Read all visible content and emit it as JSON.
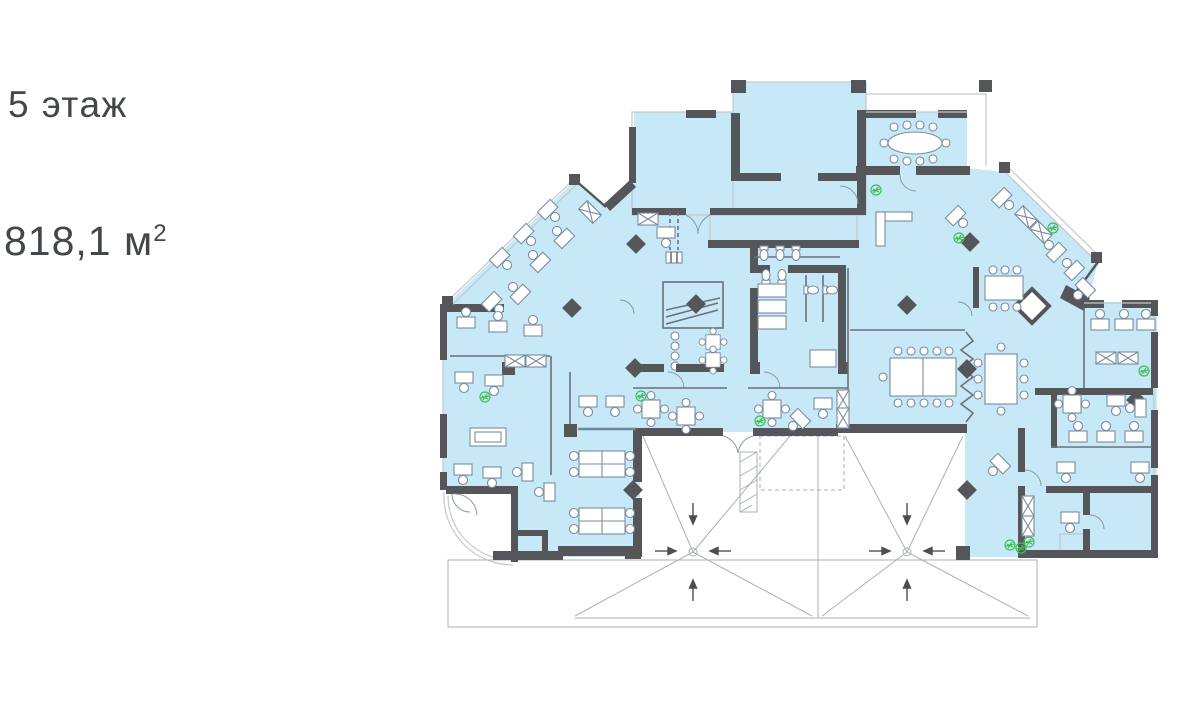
{
  "labels": {
    "floor": "5 этаж",
    "area_value": "818,1",
    "area_unit": "м",
    "area_sup": "2",
    "text_color": "#43474b"
  },
  "plan": {
    "description_icons": {
      "plant-icon": "green potted plant marker",
      "roof-drain-arrow-icon": "roof slope arrow",
      "column-icon": "dark diamond structural column",
      "elevator-icon": "dark diamond in stair core",
      "workstation-icon": "desk with chair",
      "storage-icon": "crossed box shelving",
      "toilet-icon": "wc fixture"
    },
    "colors": {
      "zone_fill": "#c7e8f6",
      "wall": "#54565a",
      "furniture_line": "#7b8da0",
      "window_line": "#c3c8cc",
      "roof_line": "#abb1b6",
      "plant": "#3fbf58",
      "arrow": "#4c4f52",
      "background": "#ffffff"
    }
  }
}
